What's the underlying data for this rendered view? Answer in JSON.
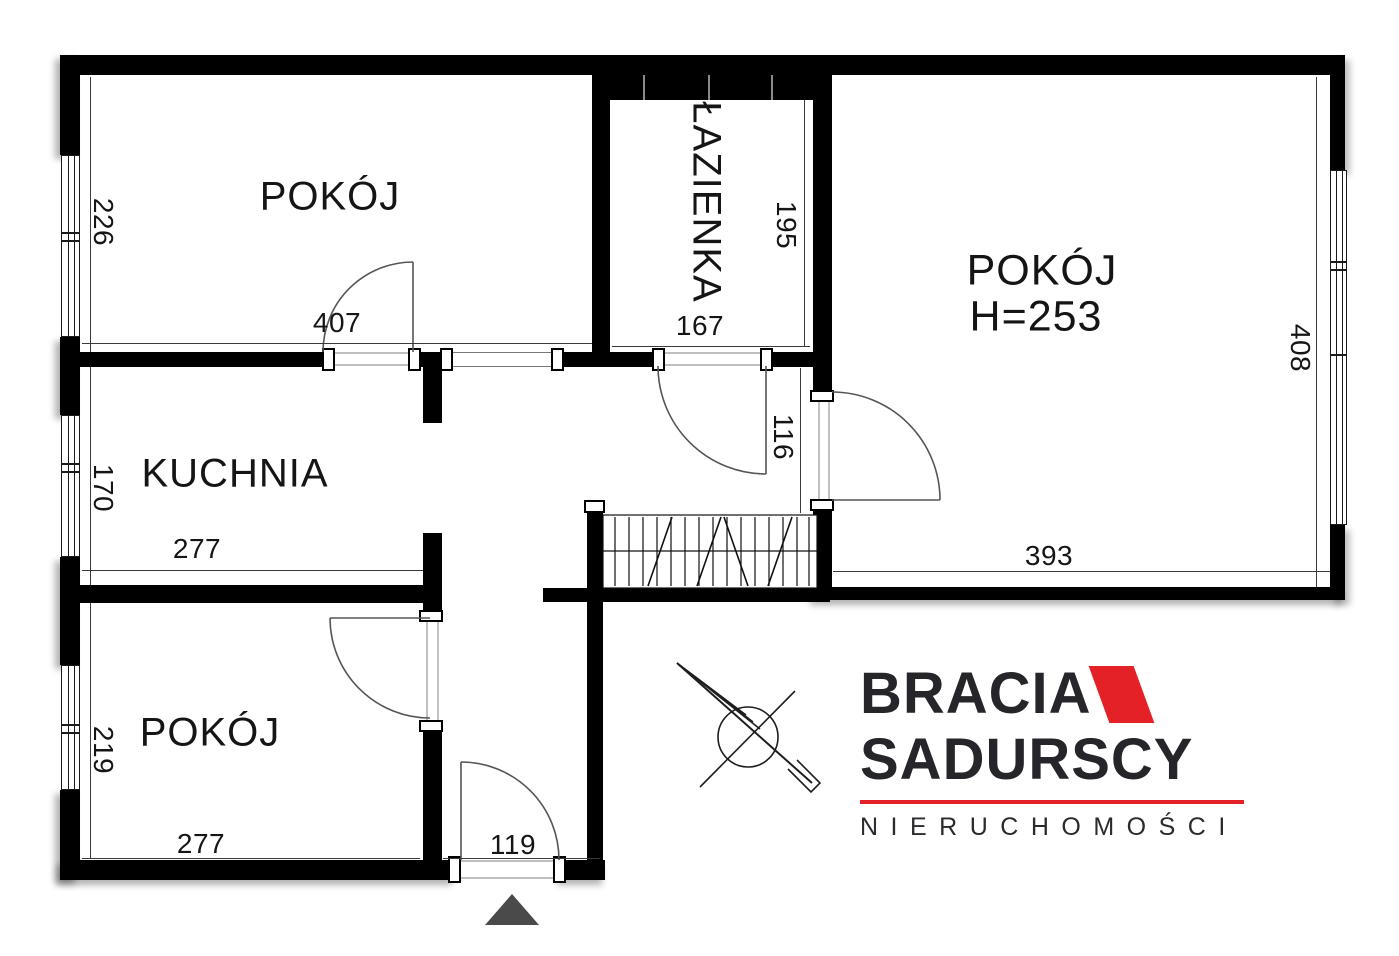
{
  "plan": {
    "rooms": {
      "room_top_left": {
        "label": "POKÓJ",
        "width_cm": "407",
        "height_cm": "226"
      },
      "bathroom": {
        "label": "ŁAZIENKA",
        "width_cm": "167",
        "height_cm": "195"
      },
      "room_right": {
        "label": "POKÓJ",
        "ceiling_height": "H=253",
        "width_cm": "393",
        "height_cm": "408"
      },
      "kitchen": {
        "label": "KUCHNIA",
        "width_cm": "277",
        "height_cm": "170"
      },
      "room_bottom_left": {
        "label": "POKÓJ",
        "width_cm": "277",
        "height_cm": "219"
      }
    },
    "hallway": {
      "recess_cm": "116",
      "entrance_cm": "119"
    }
  },
  "branding": {
    "name_line1": "BRACIA",
    "name_line2": "SADURSCY",
    "tagline": "NIERUCHOMOŚCI",
    "accent_color": "#e32127",
    "text_color": "#26252a"
  },
  "colors": {
    "walls": "#000000",
    "background": "#ffffff",
    "thin_lines": "#3a3a3a"
  }
}
